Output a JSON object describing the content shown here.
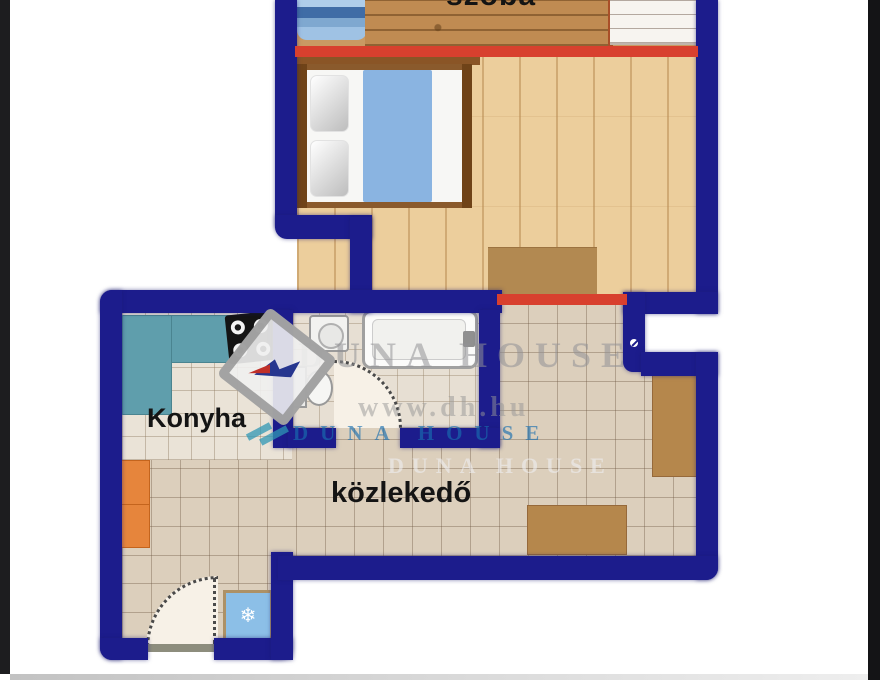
{
  "meta": {
    "kind": "real-estate floor plan",
    "language": "Hungarian"
  },
  "labels": {
    "szoba": "szoba",
    "konyha": "Konyha",
    "kozlekedo": "közlekedő"
  },
  "watermark": {
    "brand_top": "DUNA HOUSE",
    "url": "www.dh.hu",
    "brand_blue": "DUNA HOUSE",
    "brand_faint": "DUNA HOUSE"
  },
  "icons": {
    "snowflake": "❄"
  },
  "colors": {
    "wall_navy": "#1c1c8c",
    "accent_red": "#d8402e",
    "wood_floor": "#ecce9c",
    "tile_floor": "#dccfbc",
    "counter_teal": "#5f9eac",
    "cabinet_orange": "#e6853c",
    "fridge_blue": "#8cbfe7",
    "furniture_brown": "#b5874c",
    "blanket_blue": "#8ab4e1"
  }
}
